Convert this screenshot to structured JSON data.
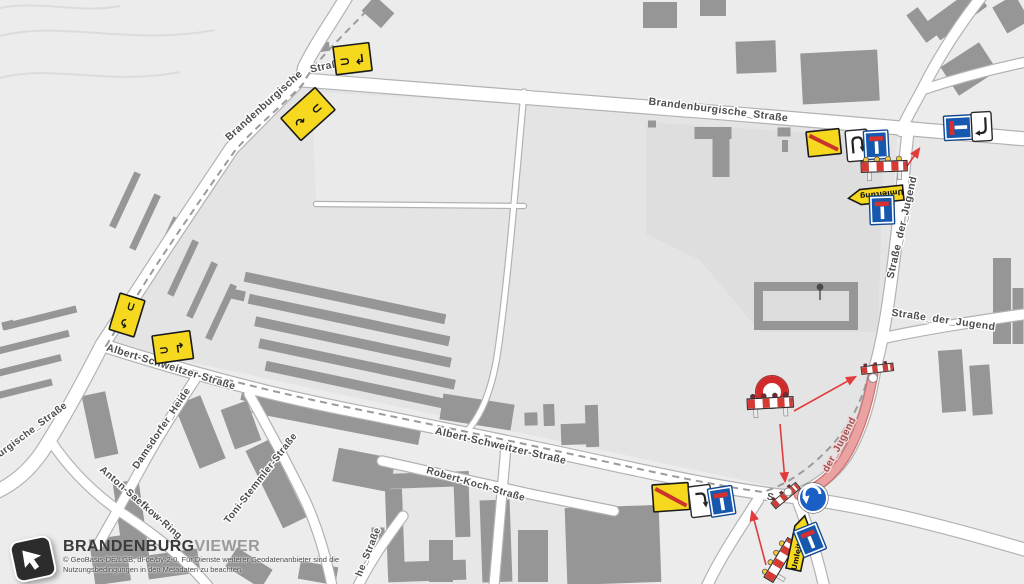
{
  "viewer": {
    "brand_bold": "BRANDENBURG",
    "brand_light": "VIEWER",
    "copyright_line1": "© GeoBasis-DE/LGB, dl-de/by-2-0. Für Dienste weiterer Geodatenanbieter sind die",
    "copyright_line2": "Nutzungsbedingungen in den Metadaten zu beachten."
  },
  "labels": {
    "brandenburgische_diag": "Brandenburgische",
    "brandenburgische_diag2": "Straße",
    "brandenburgische_top": "Brandenburgische_Straße",
    "burgische_partial": "urgische_Straße",
    "jugend_vert": "Straße_der_Jugend",
    "jugend_horiz": "Straße_der_Jugend",
    "jugend_closed_partial": "der_Jugend",
    "jugend_s_partial": "S",
    "albert_schweitzer_w": "Albert-Schweitzer-Straße",
    "albert_schweitzer_e": "Albert-Schweitzer-Straße",
    "robert_koch": "Robert-Koch-Straße",
    "damsdorfer_heide": "Damsdorfer_Heide",
    "anton_saefkow_ring": "Anton-Saefkow-Ring",
    "toni_stemmler": "Toni-Stemmler-Straße",
    "he_strasse_partial": "he_Straße"
  },
  "signs": {
    "umleitung_label": "Umleitung",
    "glyphs": {
      "detour_loop_right": "⊃",
      "detour_loop_left": "⊂",
      "arrow_hook_down_left": "↲",
      "arrow_curve_right": "↷",
      "arrow_curve_left": "↶",
      "arrow_hook_up_right": "↱"
    }
  },
  "colors": {
    "sign_yellow": "#f6d91e",
    "sign_red": "#c9342c",
    "sign_blue": "#1658ae",
    "barrier_red": "#d63a35",
    "closed_road_fill": "#eaa2a2",
    "closed_road_edge": "#cf7272",
    "detour_dash": "#9b9b9b",
    "connector": "#e23b3b",
    "road_fill": "#ffffff",
    "road_casing": "#b2b2b2",
    "building": "#969696",
    "label_text": "#4d4d4d"
  },
  "geometry": {
    "palette": [
      "#969696",
      "#a5a5a5",
      "#858585",
      "#dcdcdc"
    ],
    "shades": [
      {
        "pts": "305,82 898,127 884,340 874,368 846,456 798,492 105,344 148,276 232,148",
        "f": "#e4e4e4"
      },
      {
        "pts": "908,130 1024,140 1024,312 886,336 892,290",
        "f": "#e8e8e8"
      },
      {
        "pts": "312,92 524,104 518,206 316,204",
        "f": "#eaeaea"
      },
      {
        "pts": "646,122 884,138 878,332 760,332 700,260 646,234",
        "f": "#dedede"
      },
      {
        "pts": "390,463 610,508 604,584 392,584",
        "f": "#e7e7e7"
      }
    ],
    "contours": [
      "M 0,36 C 60,20 130,46 215,30",
      "M 0,78 C 50,64 110,86 180,72",
      "M 0,8 C 40,0 80,14 120,6"
    ],
    "roads": [
      {
        "d": "M 347,-4 C 330,24 312,50 304,68 L 302,79",
        "w": 12
      },
      {
        "d": "M 303,80 C 360,84 500,96 660,108 C 780,117 900,128 1026,139",
        "w": 13
      },
      {
        "d": "M 302,77 L 232,148 C 200,196 170,240 148,275 L 102,345 C 80,388 60,424 42,452 C 28,472 14,483 -4,492",
        "w": 13
      },
      {
        "d": "M 102,345 C 180,370 260,392 340,408 C 430,426 520,444 610,464 C 680,479 742,492 794,497 C 862,505 944,526 1026,550",
        "w": 12
      },
      {
        "d": "M 908,131 C 903,180 897,240 890,290 C 886,320 880,350 875,368",
        "w": 11
      },
      {
        "d": "M 875,368 C 870,402 860,433 846,456 C 832,476 815,488 797,494",
        "w": 11
      },
      {
        "d": "M 796,496 C 805,520 816,550 824,586",
        "w": 10
      },
      {
        "d": "M 758,500 C 739,530 721,556 707,586",
        "w": 10
      },
      {
        "d": "M 884,338 C 920,330 970,322 1026,314",
        "w": 10
      },
      {
        "d": "M 982,-4 C 960,24 938,58 922,90 C 913,107 905,120 901,131",
        "w": 10
      },
      {
        "d": "M 922,90 C 952,80 988,70 1026,62",
        "w": 9
      },
      {
        "d": "M 196,378 C 175,410 156,440 140,470 C 126,496 112,520 98,545",
        "w": 9
      },
      {
        "d": "M 50,440 C 70,470 95,495 125,515 C 155,535 185,558 208,586",
        "w": 9
      },
      {
        "d": "M 249,394 C 268,428 288,465 305,500 C 315,522 325,552 332,586",
        "w": 9
      },
      {
        "d": "M 382,461 C 430,472 480,483 530,494 C 560,500 590,506 614,511",
        "w": 9
      },
      {
        "d": "M 506,446 C 502,490 498,535 494,586",
        "w": 9
      },
      {
        "d": "M 403,516 C 388,536 372,558 358,586",
        "w": 9
      },
      {
        "d": "M 524,92 C 516,180 508,280 498,350 C 492,392 480,416 468,430",
        "w": 5
      },
      {
        "d": "M 316,204 L 524,206",
        "w": 4
      }
    ],
    "dashed_route": "M 375,2 C 345,34 312,64 303,84 C 282,106 252,130 234,152 C 200,200 170,244 148,278 L 106,346 C 180,368 262,390 346,407 C 440,426 540,447 630,467 C 690,480 732,488 763,492 C 789,484 813,466 833,444 C 851,423 862,400 868,377",
    "closed_road": "M 874,369 C 869,402 859,434 845,457 C 832,477 816,489 799,495",
    "buildings": [
      [
        378,
        12,
        26,
        20,
        42
      ],
      [
        324,
        47,
        11,
        9,
        -8
      ],
      [
        125,
        200,
        7,
        60,
        25
      ],
      [
        145,
        222,
        7,
        60,
        25
      ],
      [
        164,
        245,
        7,
        60,
        25
      ],
      [
        183,
        268,
        7,
        60,
        25
      ],
      [
        202,
        290,
        7,
        60,
        25
      ],
      [
        221,
        312,
        7,
        60,
        25
      ],
      [
        40,
        318,
        75,
        7,
        -14
      ],
      [
        34,
        342,
        72,
        7,
        -14
      ],
      [
        27,
        366,
        70,
        7,
        -14
      ],
      [
        20,
        390,
        66,
        7,
        -14
      ],
      [
        8,
        325,
        12,
        8,
        -14
      ],
      [
        345,
        298,
        205,
        10,
        12
      ],
      [
        349,
        320,
        205,
        10,
        12
      ],
      [
        353,
        342,
        200,
        10,
        12
      ],
      [
        357,
        364,
        200,
        10,
        12
      ],
      [
        361,
        386,
        195,
        10,
        12
      ],
      [
        300,
        408,
        120,
        9,
        12
      ],
      [
        238,
        295,
        14,
        10,
        12
      ],
      [
        100,
        425,
        24,
        64,
        -12
      ],
      [
        131,
        520,
        26,
        78,
        -8
      ],
      [
        200,
        432,
        28,
        68,
        -22
      ],
      [
        241,
        425,
        28,
        42,
        -20
      ],
      [
        337,
        417,
        170,
        24,
        11
      ],
      [
        477,
        412,
        72,
        26,
        9
      ],
      [
        276,
        484,
        26,
        86,
        -26
      ],
      [
        364,
        470,
        58,
        34,
        11
      ],
      [
        110,
        560,
        36,
        46,
        -8
      ],
      [
        173,
        564,
        52,
        24,
        -8
      ],
      [
        249,
        568,
        42,
        22,
        32
      ],
      [
        318,
        573,
        38,
        18,
        10
      ],
      [
        441,
        561,
        24,
        42,
        0
      ],
      [
        378,
        533,
        13,
        11,
        0
      ],
      [
        427,
        480,
        84,
        15,
        -2
      ],
      [
        395,
        533,
        17,
        88,
        -2
      ],
      [
        427,
        571,
        78,
        20,
        -2
      ],
      [
        462,
        509,
        15,
        56,
        -2
      ],
      [
        496,
        541,
        30,
        82,
        -2
      ],
      [
        531,
        419,
        13,
        13,
        -2
      ],
      [
        549,
        415,
        11,
        22,
        -2
      ],
      [
        579,
        434,
        36,
        21,
        -2
      ],
      [
        592,
        426,
        13,
        42,
        -2
      ],
      [
        613,
        545,
        94,
        77,
        -2
      ],
      [
        533,
        556,
        30,
        52,
        0
      ],
      [
        713,
        133,
        37,
        12,
        0
      ],
      [
        721,
        158,
        17,
        38,
        0
      ],
      [
        652,
        124,
        8,
        7,
        0
      ],
      [
        784,
        132,
        13,
        9,
        0
      ],
      [
        785,
        146,
        6,
        12,
        0
      ],
      [
        756,
        57,
        40,
        32,
        -2
      ],
      [
        840,
        77,
        77,
        51,
        -3
      ],
      [
        957,
        14,
        58,
        23,
        -36
      ],
      [
        1011,
        14,
        26,
        30,
        -30
      ],
      [
        969,
        69,
        46,
        34,
        -33
      ],
      [
        922,
        25,
        14,
        34,
        -36
      ],
      [
        1002,
        301,
        18,
        86,
        0
      ],
      [
        1018,
        316,
        11,
        56,
        0
      ],
      [
        952,
        381,
        24,
        62,
        -4
      ],
      [
        981,
        390,
        20,
        50,
        -4
      ],
      [
        660,
        15,
        34,
        26,
        0
      ],
      [
        713,
        8,
        26,
        16,
        0
      ],
      [
        806,
        306,
        104,
        48,
        0
      ],
      [
        806,
        306,
        86,
        30,
        0,
        3
      ]
    ]
  }
}
